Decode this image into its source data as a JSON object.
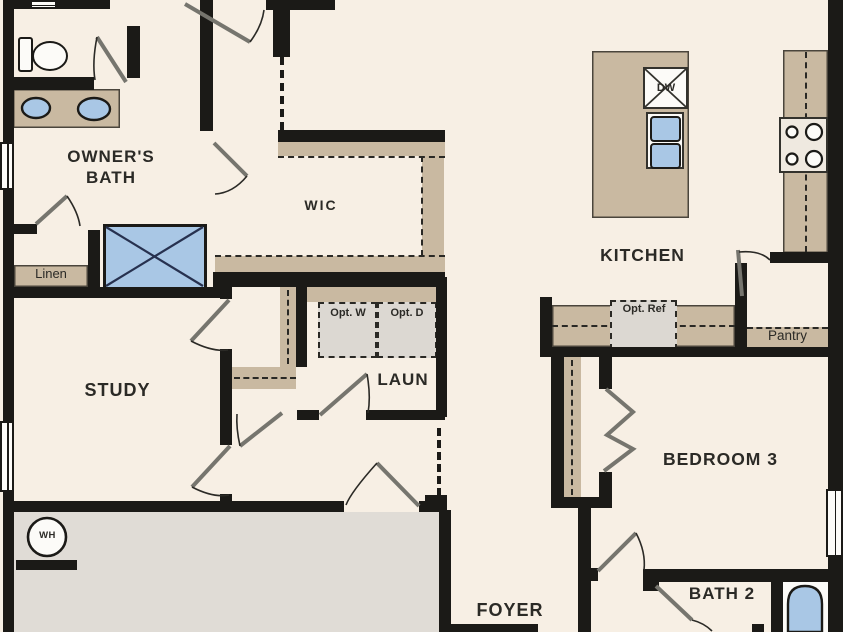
{
  "title": "Floor plan",
  "labels": {
    "owners_bath": "OWNER'S BATH",
    "wic": "WIC",
    "kitchen": "KITCHEN",
    "study": "STUDY",
    "laundry": "LAUN",
    "bedroom3": "BEDROOM 3",
    "foyer": "FOYER",
    "bath2": "BATH 2",
    "linen": "Linen",
    "pantry": "Pantry",
    "opt_washer": "Opt. W",
    "opt_dryer": "Opt. D",
    "opt_ref": "Opt. Ref",
    "dishwasher": "DW",
    "water_heater": "WH"
  },
  "colors": {
    "wall": "#1b1a17",
    "floor": "#f7efe4",
    "cabinet": "#c9b9a1",
    "fixture_blue": "#a9c7e5",
    "garage_floor": "#e0dcd6",
    "optional_box": "#dcd8d2",
    "label_text": "#2b2a26"
  }
}
